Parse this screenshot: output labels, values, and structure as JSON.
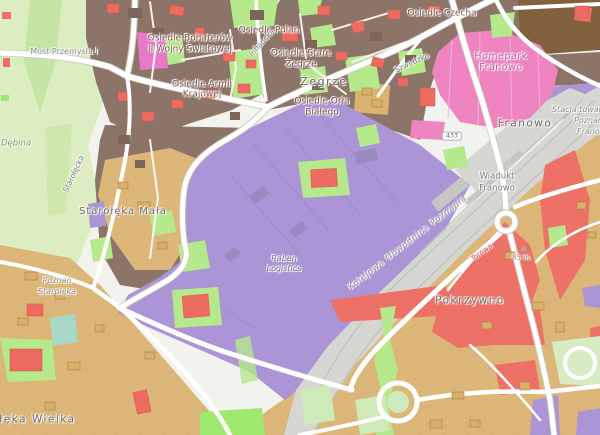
{
  "map": {
    "labels": {
      "bridge": "Most Przemysła I",
      "park_debina": "Dębina",
      "osiedle_bohaterow_1": "Osiedle Bohaterów",
      "osiedle_bohaterow_2": "II Wojny Światowej",
      "osiedle_armii_1": "Osiedle Armii",
      "osiedle_armii_2": "Krajowej",
      "osiedle_polan": "Osiedle Polan",
      "osiedle_stare_zegrze_1": "Osiedle Stare",
      "osiedle_stare_zegrze_2": "Żegrze",
      "zegrze": "Żegrze",
      "osiedle_orla_1": "Osiedle Orła",
      "osiedle_orla_2": "Białego",
      "osiedle_czecha": "Osiedle Czecha",
      "homepark_1": "Homepark",
      "homepark_2": "Franowo",
      "franowo": "Franowo",
      "stacja_towarowa_1": "Stacja towarowa",
      "stacja_towarowa_2": "Poznań",
      "stacja_towarowa_3": "Franowo",
      "wiadukt_1": "Wiadukt",
      "wiadukt_2": "Franowo",
      "obwodnica": "Kolejowa Obwodnica Poznania",
      "raben_1": "Raben",
      "raben_2": "Logistics",
      "starolecka_mala": "Starołęka Mała",
      "stacja_starolecka_1": "Poznań",
      "stacja_starolecka_2": "Starołęka",
      "starolecka_wielka": "Starołęka Wielka",
      "pokrzywno": "Pokrzywno",
      "street_torowa": "Torowa",
      "street_szwedzka": "Szwedzka",
      "street_inflancka": "Inflancka",
      "street_starolecka": "Starołęcka",
      "elevation": "85 m",
      "route_shield": "433"
    },
    "palette": {
      "residential_brown": "#8d7468",
      "farmland_tan": "#ddb77a",
      "industrial_purple": "#ab95d6",
      "commercial_pink": "#ee84c0",
      "red_zone": "#ed7166",
      "green_area": "#b5e98c",
      "park_green": "#dcedc1",
      "rail_gray": "#d6d6d2",
      "teal_zone": "#a9d8c8",
      "road_white": "#ffffff"
    }
  }
}
